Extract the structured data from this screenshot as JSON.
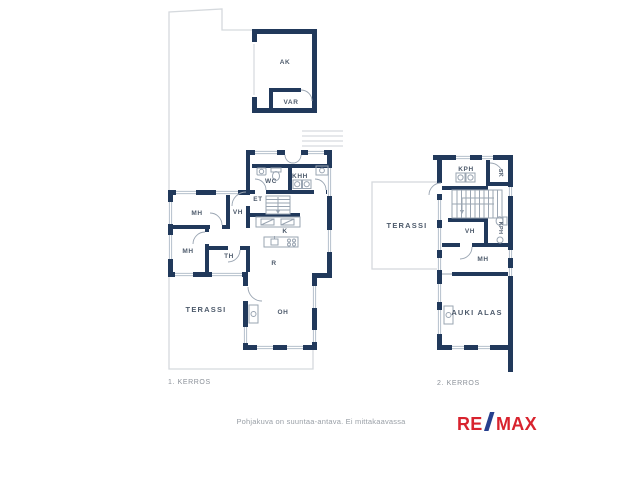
{
  "document_type": "floor-plan",
  "floor1": {
    "caption": "1. KERROS",
    "rooms": {
      "ak": "AK",
      "var": "VAR",
      "wc": "WC",
      "khh": "KHH",
      "et": "ET",
      "mh1": "MH",
      "vh": "VH",
      "mh2": "MH",
      "th": "TH",
      "k": "K",
      "r": "R",
      "terassi": "TERASSI",
      "oh": "OH"
    }
  },
  "floor2": {
    "caption": "2. KERROS",
    "rooms": {
      "terassi": "TERASSI",
      "kph1": "KPH",
      "sk": "SK",
      "vh": "VH",
      "kph2": "KPH",
      "mh": "MH",
      "auki_alas": "AUKI ALAS"
    }
  },
  "footer": {
    "disclaimer": "Pohjakuva on suuntaa-antava. Ei mittakaavassa"
  },
  "logo": {
    "part1": "RE",
    "slash": "/",
    "part2": "MAX"
  },
  "colors": {
    "wall": "#21395b",
    "window_line": "#b5c0cc",
    "site_outline": "#d5d9dd",
    "room_label": "#4d5a6b",
    "caption_text": "#8b9199",
    "logo_red": "#d8232e",
    "logo_blue": "#263f8e"
  }
}
